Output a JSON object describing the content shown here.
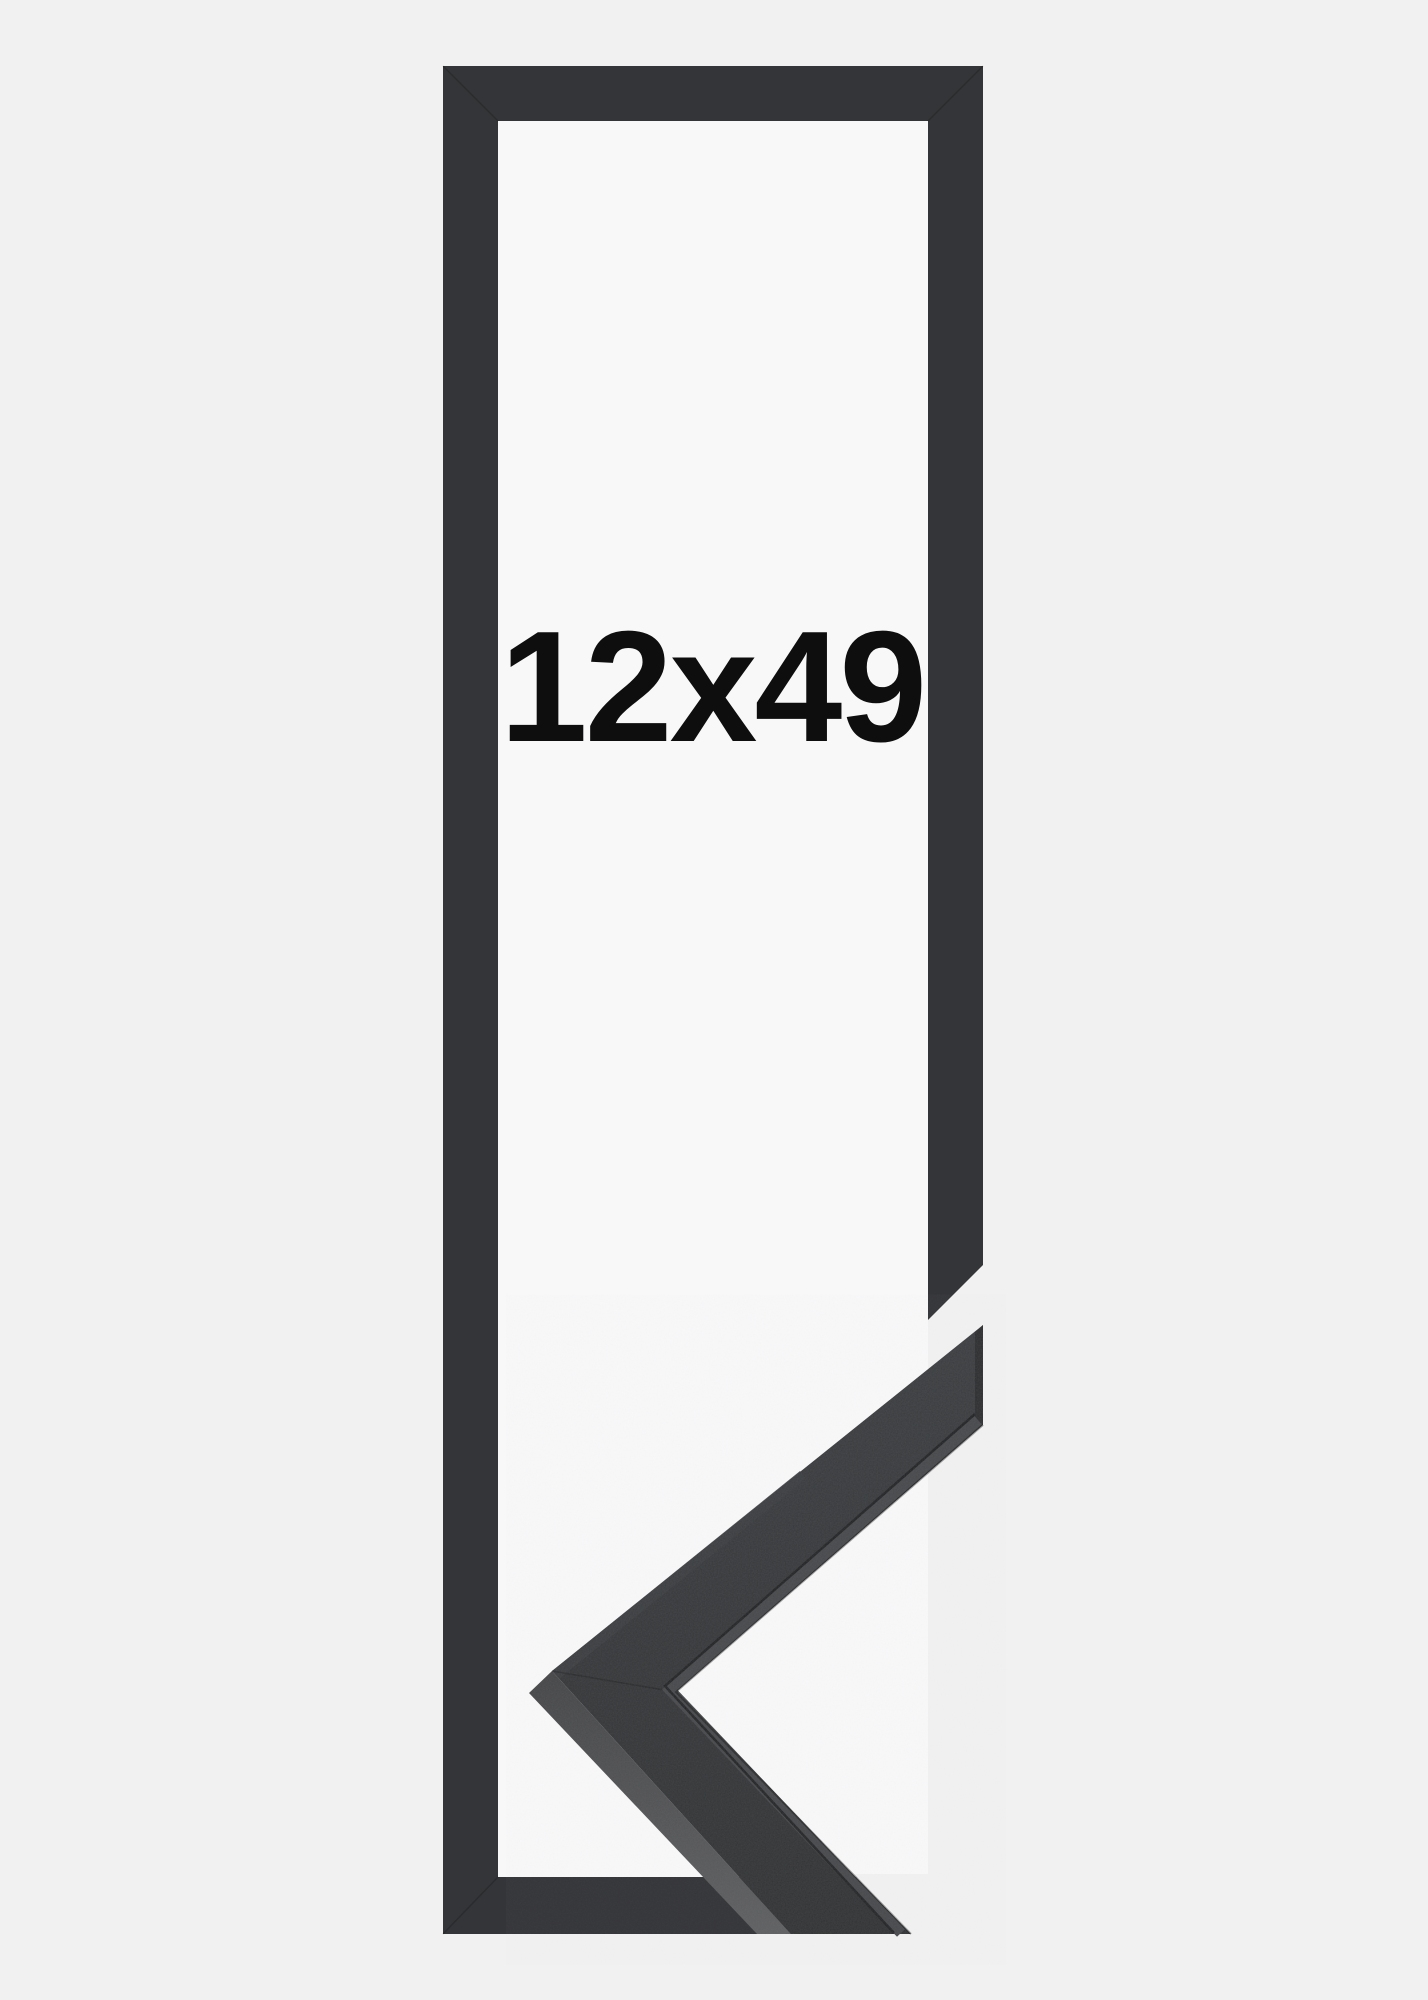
{
  "product": {
    "size_label": "12x49",
    "width": "12",
    "height": "49"
  },
  "colors": {
    "background": "#f1f1f2",
    "frame_interior": "#f8f8f9",
    "frame_graphic": "#343538",
    "sample_face_light": "#3b3d40",
    "sample_face_dark": "#2e3032",
    "sample_side_dark": "#434446",
    "sample_side_light": "#5f6062",
    "sample_lip": "#46484b",
    "sample_end": "#2a2b2d",
    "edge_dark": "#1b1c1e",
    "label_text": "#0e0e0e"
  }
}
